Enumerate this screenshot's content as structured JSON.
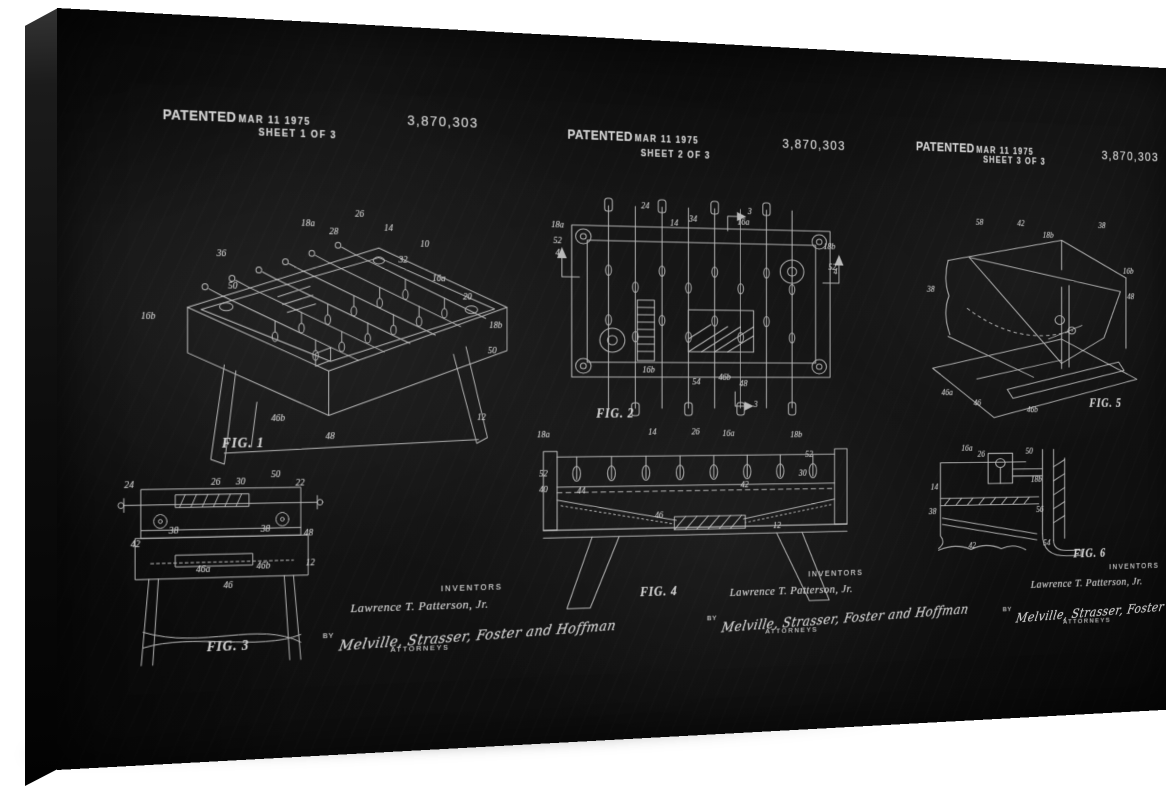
{
  "artwork": {
    "patented_label": "PATENTED",
    "patent_date": "MAR 11 1975",
    "patent_number": "3,870,303",
    "inventors_label": "INVENTORS",
    "inventor_name": "Lawrence T. Patterson, Jr.",
    "by_label": "BY",
    "attorneys_signature": "Melville, Strasser, Foster and Hoffman",
    "attorneys_label": "ATTORNEYS",
    "colors": {
      "background": "#ffffff",
      "board": "#121212",
      "chalk": "#cfcfcf"
    }
  },
  "sheets": [
    {
      "sheet_label": "SHEET 1 OF 3",
      "figures": [
        {
          "label": "FIG. 1",
          "callouts": [
            {
              "t": "18a",
              "x": 44,
              "y": 6
            },
            {
              "t": "36",
              "x": 21,
              "y": 18
            },
            {
              "t": "50",
              "x": 24,
              "y": 30
            },
            {
              "t": "28",
              "x": 51,
              "y": 9
            },
            {
              "t": "26",
              "x": 58,
              "y": 2
            },
            {
              "t": "14",
              "x": 66,
              "y": 7
            },
            {
              "t": "10",
              "x": 76,
              "y": 13
            },
            {
              "t": "32",
              "x": 70,
              "y": 19
            },
            {
              "t": "16a",
              "x": 80,
              "y": 26
            },
            {
              "t": "20",
              "x": 88,
              "y": 33
            },
            {
              "t": "18b",
              "x": 96,
              "y": 44
            },
            {
              "t": "50",
              "x": 95,
              "y": 54
            },
            {
              "t": "12",
              "x": 92,
              "y": 80
            },
            {
              "t": "16b",
              "x": 2,
              "y": 42
            },
            {
              "t": "46b",
              "x": 36,
              "y": 80
            },
            {
              "t": "48",
              "x": 50,
              "y": 87
            }
          ]
        },
        {
          "label": "FIG. 3",
          "callouts": [
            {
              "t": "24",
              "x": 6,
              "y": 8
            },
            {
              "t": "26",
              "x": 47,
              "y": 7
            },
            {
              "t": "30",
              "x": 59,
              "y": 7
            },
            {
              "t": "50",
              "x": 76,
              "y": 4
            },
            {
              "t": "22",
              "x": 88,
              "y": 8
            },
            {
              "t": "38",
              "x": 27,
              "y": 31
            },
            {
              "t": "38",
              "x": 71,
              "y": 31
            },
            {
              "t": "42",
              "x": 9,
              "y": 37
            },
            {
              "t": "48",
              "x": 92,
              "y": 33
            },
            {
              "t": "46a",
              "x": 41,
              "y": 50
            },
            {
              "t": "46",
              "x": 53,
              "y": 58
            },
            {
              "t": "46b",
              "x": 70,
              "y": 49
            },
            {
              "t": "12",
              "x": 93,
              "y": 48
            }
          ]
        }
      ]
    },
    {
      "sheet_label": "SHEET 2 OF 3",
      "figures": [
        {
          "label": "FIG. 2",
          "callouts": [
            {
              "t": "24",
              "x": 31,
              "y": 6
            },
            {
              "t": "14",
              "x": 40,
              "y": 13
            },
            {
              "t": "34",
              "x": 46,
              "y": 11
            },
            {
              "t": "16a",
              "x": 62,
              "y": 12
            },
            {
              "t": "18a",
              "x": 4,
              "y": 15
            },
            {
              "t": "52",
              "x": 4,
              "y": 22
            },
            {
              "t": "4",
              "x": 4,
              "y": 27
            },
            {
              "t": "3",
              "x": 64,
              "y": 7
            },
            {
              "t": "18b",
              "x": 90,
              "y": 22
            },
            {
              "t": "52",
              "x": 91,
              "y": 31
            },
            {
              "t": "4",
              "x": 92,
              "y": 33
            },
            {
              "t": "16b",
              "x": 32,
              "y": 77
            },
            {
              "t": "54",
              "x": 47,
              "y": 82
            },
            {
              "t": "46b",
              "x": 56,
              "y": 80
            },
            {
              "t": "48",
              "x": 62,
              "y": 83
            },
            {
              "t": "3",
              "x": 66,
              "y": 92
            }
          ]
        },
        {
          "label": "FIG. 4",
          "callouts": [
            {
              "t": "18a",
              "x": 4,
              "y": 4
            },
            {
              "t": "14",
              "x": 36,
              "y": 3
            },
            {
              "t": "26",
              "x": 49,
              "y": 3
            },
            {
              "t": "16a",
              "x": 59,
              "y": 4
            },
            {
              "t": "18b",
              "x": 80,
              "y": 5
            },
            {
              "t": "52",
              "x": 84,
              "y": 16
            },
            {
              "t": "52",
              "x": 4,
              "y": 25
            },
            {
              "t": "30",
              "x": 82,
              "y": 27
            },
            {
              "t": "40",
              "x": 4,
              "y": 34
            },
            {
              "t": "44",
              "x": 15,
              "y": 35
            },
            {
              "t": "42",
              "x": 64,
              "y": 33
            },
            {
              "t": "46",
              "x": 38,
              "y": 49
            },
            {
              "t": "12",
              "x": 74,
              "y": 56
            }
          ]
        }
      ]
    },
    {
      "sheet_label": "SHEET 3 OF 3",
      "figures": [
        {
          "label": "FIG. 5",
          "callouts": [
            {
              "t": "58",
              "x": 26,
              "y": 8
            },
            {
              "t": "42",
              "x": 44,
              "y": 8
            },
            {
              "t": "18b",
              "x": 56,
              "y": 13
            },
            {
              "t": "38",
              "x": 80,
              "y": 8
            },
            {
              "t": "38",
              "x": 5,
              "y": 39
            },
            {
              "t": "16b",
              "x": 92,
              "y": 29
            },
            {
              "t": "48",
              "x": 93,
              "y": 41
            },
            {
              "t": "46a",
              "x": 12,
              "y": 86
            },
            {
              "t": "46",
              "x": 25,
              "y": 91
            },
            {
              "t": "46b",
              "x": 49,
              "y": 94
            }
          ]
        },
        {
          "label": "FIG. 6",
          "callouts": [
            {
              "t": "16a",
              "x": 21,
              "y": 9
            },
            {
              "t": "26",
              "x": 29,
              "y": 13
            },
            {
              "t": "50",
              "x": 56,
              "y": 11
            },
            {
              "t": "14",
              "x": 3,
              "y": 36
            },
            {
              "t": "18b",
              "x": 60,
              "y": 32
            },
            {
              "t": "38",
              "x": 2,
              "y": 54
            },
            {
              "t": "56",
              "x": 62,
              "y": 54
            },
            {
              "t": "42",
              "x": 24,
              "y": 79
            },
            {
              "t": "54",
              "x": 66,
              "y": 78
            }
          ]
        }
      ]
    }
  ]
}
